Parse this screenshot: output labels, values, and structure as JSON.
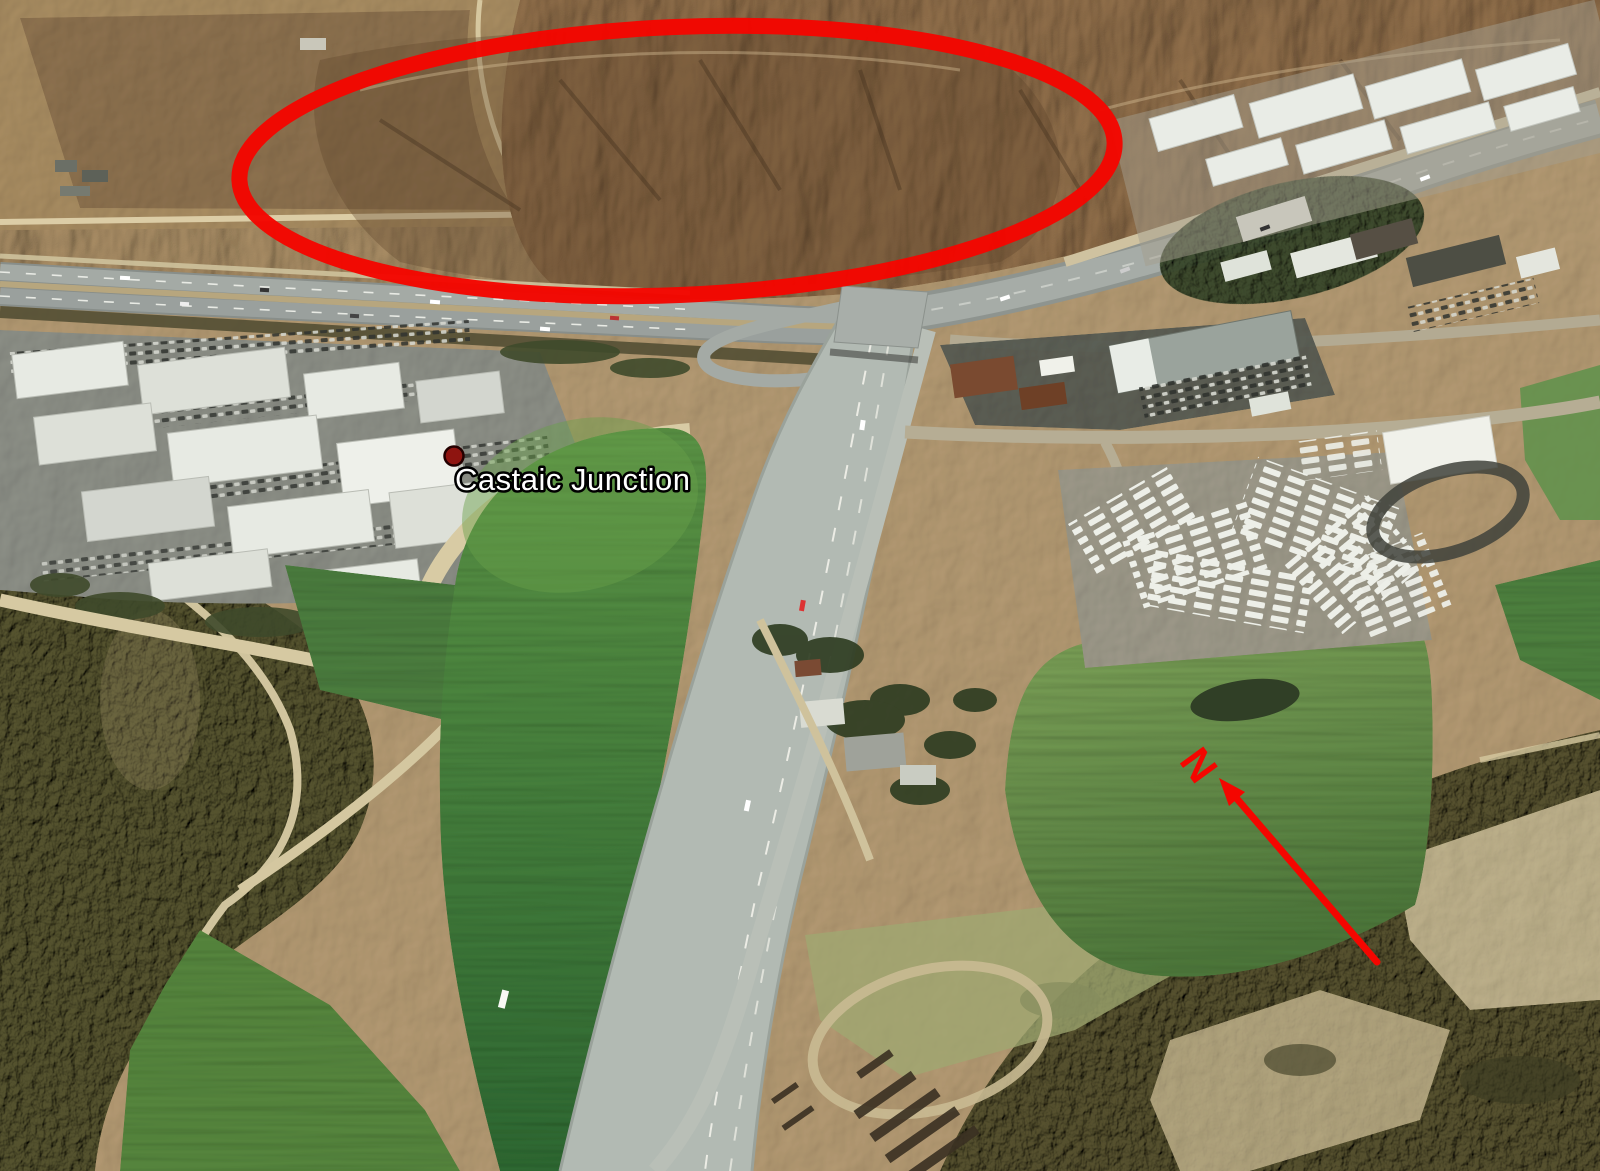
{
  "annotations": {
    "place_label": "Castaic Junction",
    "north_label": "N",
    "colors": {
      "annotation_red": "#f40600",
      "marker_fill": "#8e1410",
      "marker_outline": "#230000",
      "label_fill": "#ffffff",
      "label_outline": "#000000"
    }
  }
}
